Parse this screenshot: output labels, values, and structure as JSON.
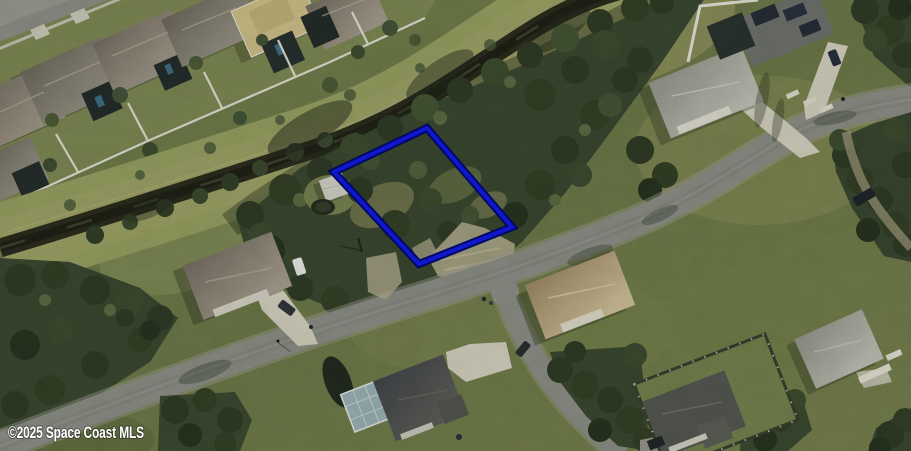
{
  "watermark": {
    "text": "©2025 Space Coast MLS",
    "color": "#ffffff"
  },
  "parcel_outline": {
    "points": "427,128 512,227 419,264 334,172",
    "stroke_color": "#1117cf",
    "outer_stroke_color": "#000a63",
    "stroke_width": "4",
    "outer_stroke_width": "8"
  }
}
